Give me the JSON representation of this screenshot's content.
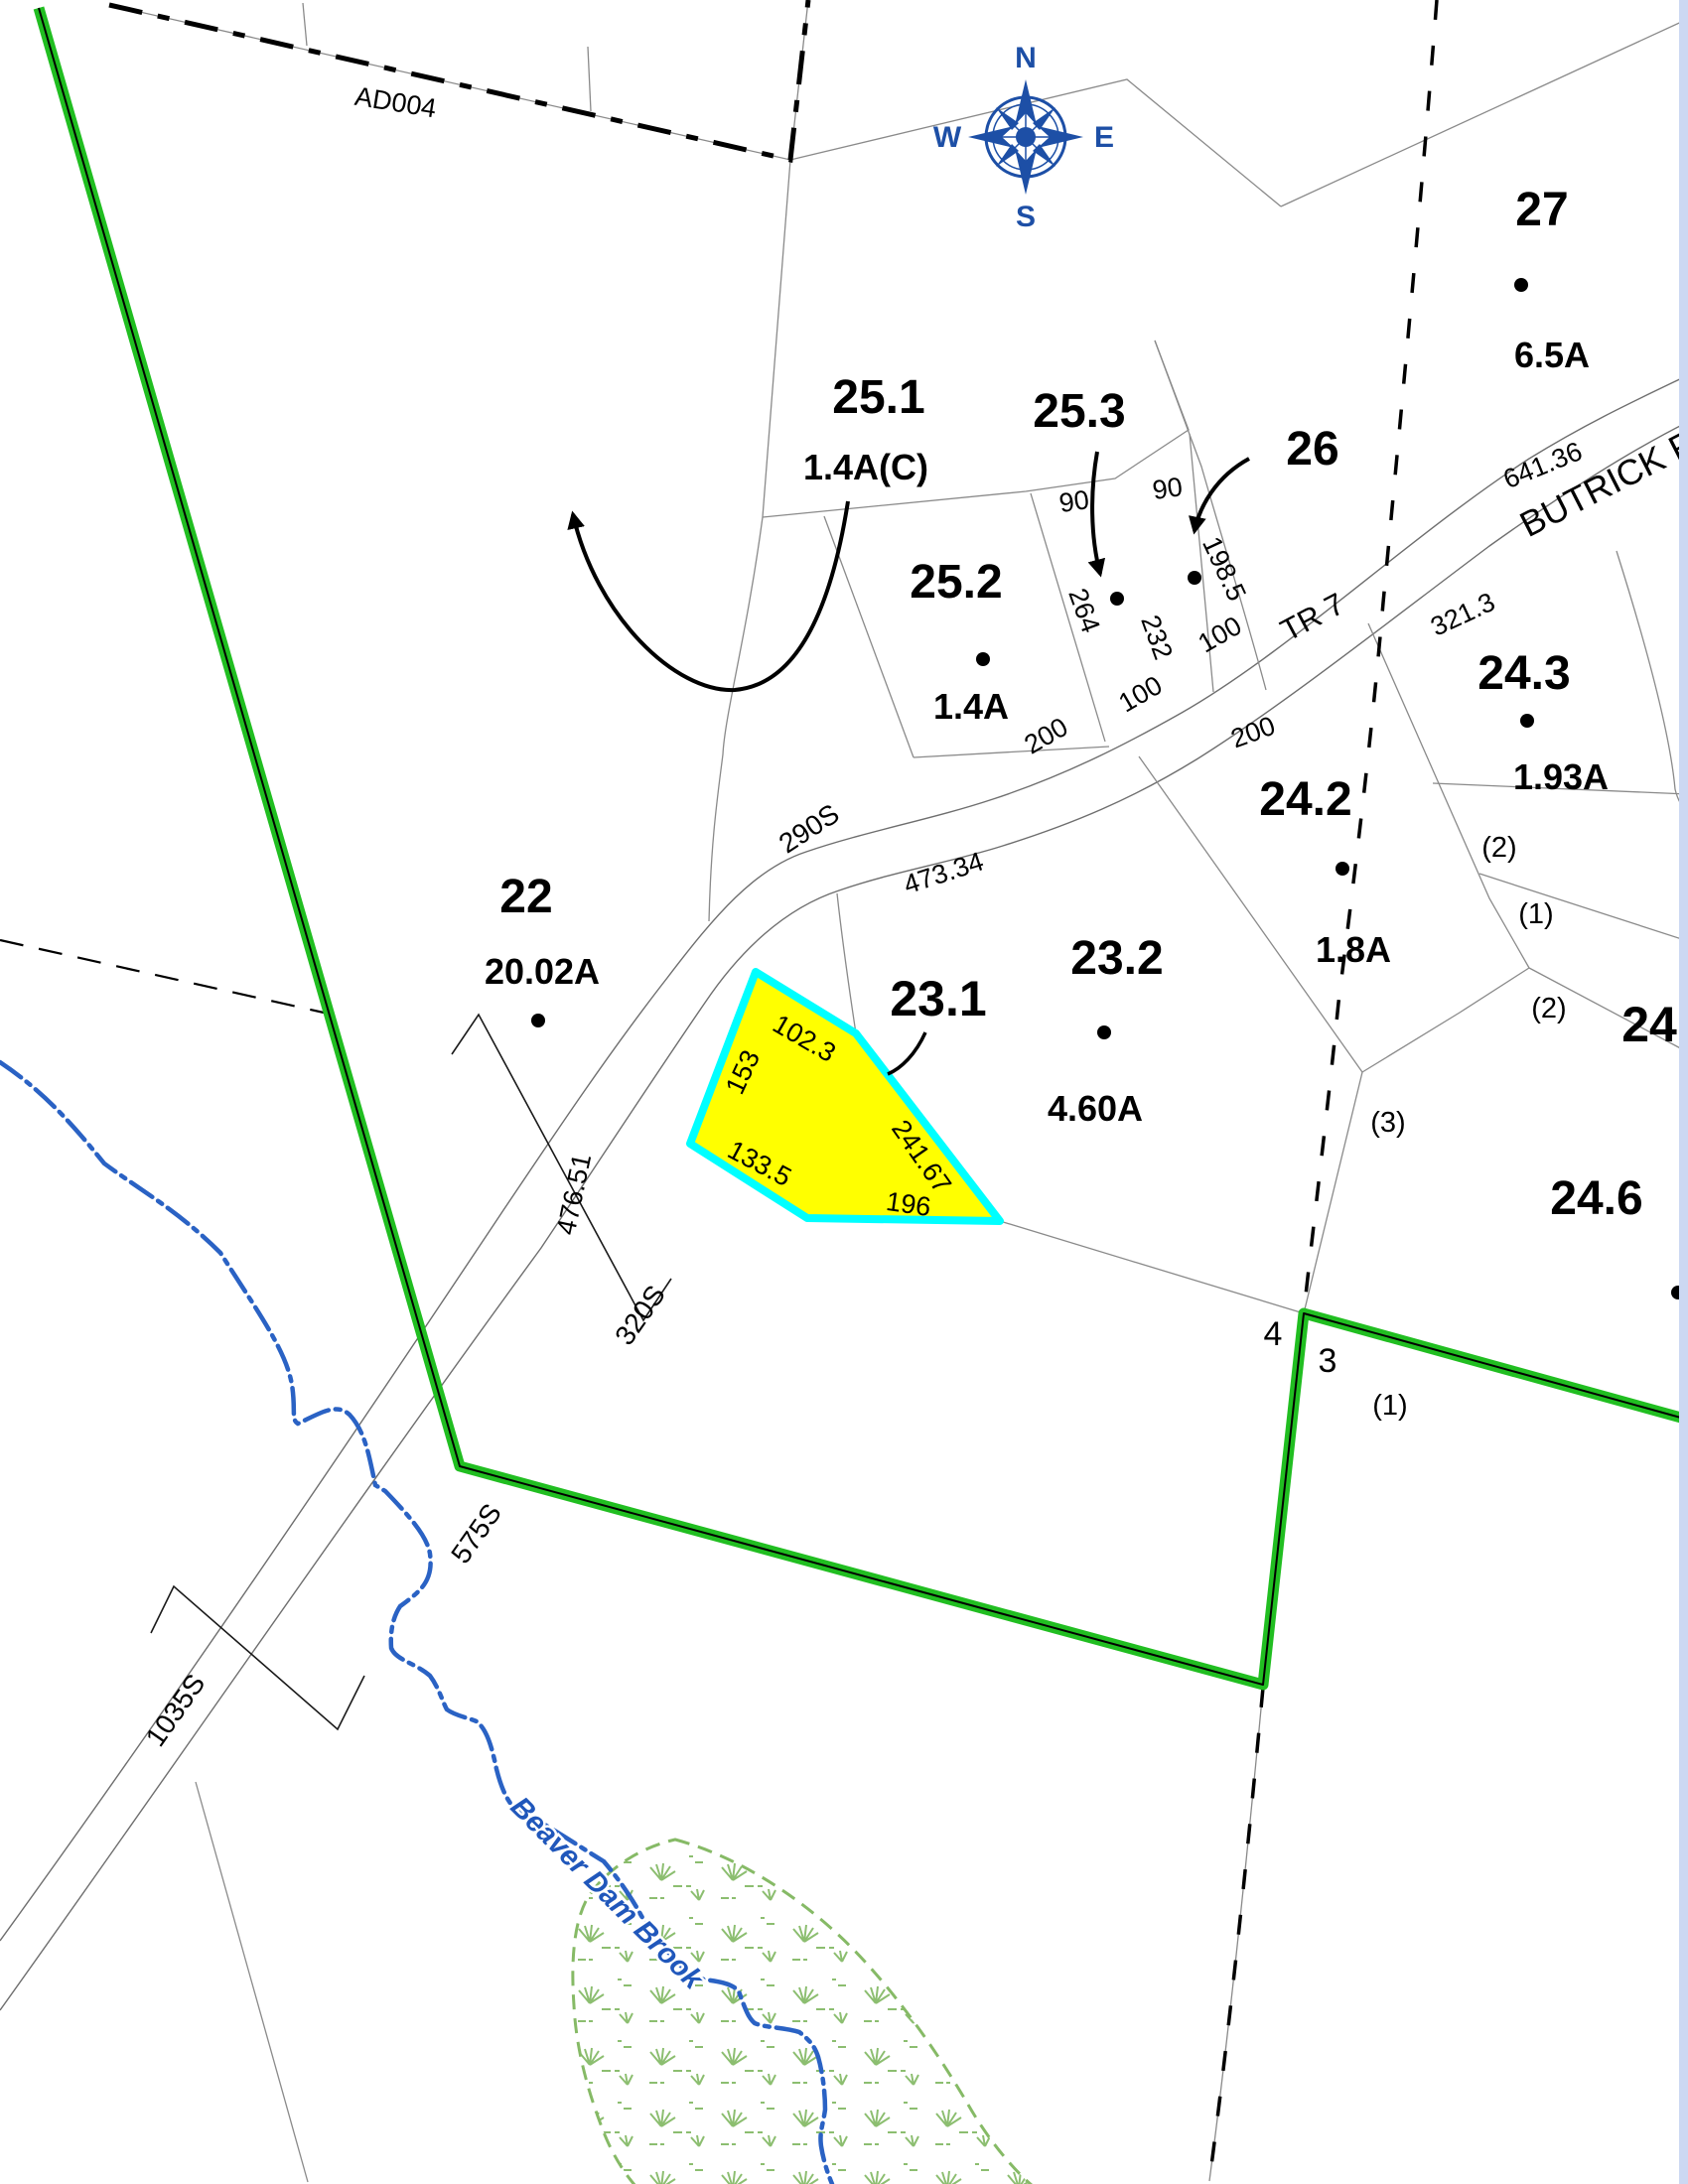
{
  "map": {
    "kind": "tax-parcel-map",
    "colors": {
      "highlight_fill": "#ffff00",
      "highlight_outline": "#00ffff",
      "boundary_green": "#21be21",
      "water_blue": "#2a62c4",
      "wetland_green": "#8cbe70",
      "compass_blue": "#1d4fa6",
      "viewport_edge": "#ccd8f2"
    }
  },
  "compass": {
    "north": "N",
    "south": "S",
    "east": "E",
    "west": "W"
  },
  "parcels": {
    "p27": {
      "id": "27",
      "area": "6.5A"
    },
    "p25_1": {
      "id": "25.1",
      "area": "1.4A(C)"
    },
    "p25_2": {
      "id": "25.2",
      "area": "1.4A"
    },
    "p25_3": {
      "id": "25.3"
    },
    "p26": {
      "id": "26"
    },
    "p24_3": {
      "id": "24.3",
      "area": "1.93A"
    },
    "p24_2": {
      "id": "24.2",
      "area": "1.8A"
    },
    "p24_6": {
      "id": "24.6"
    },
    "p24_x": {
      "id": "24."
    },
    "p23_2": {
      "id": "23.2",
      "area": "4.60A"
    },
    "p23_1": {
      "id": "23.1",
      "highlighted": true
    },
    "p22": {
      "id": "22",
      "area": "20.02A"
    }
  },
  "subdivision_marks": {
    "s2a": "(2)",
    "s1a": "(1)",
    "s2b": "(2)",
    "s3": "(3)",
    "s1b": "(1)",
    "n4": "4",
    "n3": "3"
  },
  "dimensions": {
    "d90a": "90",
    "d90b": "90",
    "d264": "264",
    "d232": "232",
    "d198_5": "198.5",
    "d100a": "100",
    "d100b": "100",
    "d200a": "200",
    "d200b": "200",
    "d641_36": "641.36",
    "d321_3": "321.3",
    "d473_34": "473.34",
    "d476_51": "476.51",
    "d102_3": "102.3",
    "d153": "153",
    "d133_5": "133.5",
    "d241_67": "241.67",
    "d196": "196"
  },
  "roads": {
    "tr7": "TR 7",
    "butrick": "BUTRICK R"
  },
  "stations": {
    "d290s": "290S",
    "d320s": "320S",
    "d575s": "575S",
    "d1035s": "1035S"
  },
  "annotations": {
    "ad004": "AD004"
  },
  "water": {
    "brook_name": "Beaver Dam Brook"
  }
}
